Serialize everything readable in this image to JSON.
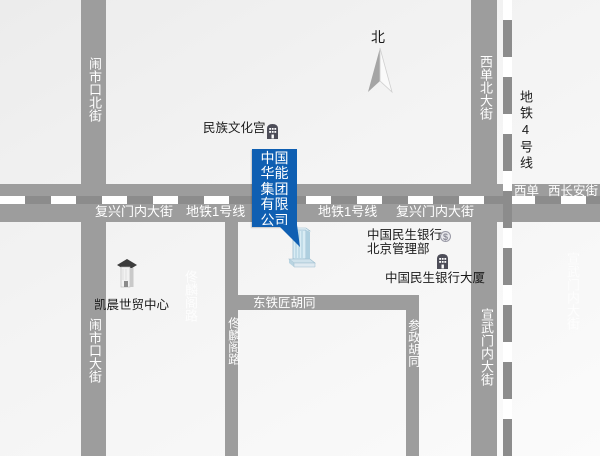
{
  "map": {
    "compass_label": "北",
    "callout": {
      "company_lines": [
        "中国",
        "华能",
        "集团",
        "有限",
        "公司"
      ],
      "full_name": "中国华能集团有限公司",
      "color": "#0f5fb2"
    },
    "roads": {
      "naoshikou_north": "闹市口北街",
      "naoshikou_south": "闹市口大街",
      "xidan_north": "西单北大街",
      "xuanwumen": "宣武门内大街",
      "tonglinge": "佟麟阁路",
      "canzheng": "参政胡同",
      "dongtiejiang": "东铁匠胡同",
      "fuxingmen": "复兴门内大街",
      "xichangan": "西长安街",
      "xidan_area": "西单"
    },
    "metro": {
      "line1": "地铁1号线",
      "line4": "地铁4号线"
    },
    "pois": {
      "minzu": "民族文化宫",
      "kaichen": "凯晨世贸中心",
      "minsheng_mgmt_line1": "中国民生银行",
      "minsheng_mgmt_line2": "北京管理部",
      "minsheng_tower": "中国民生银行大厦"
    },
    "icons": {
      "bank_symbol": "$"
    },
    "watermarks": {
      "left": "佟麟阁路",
      "right": "宣武门内大街"
    },
    "colors": {
      "road": "#9d9d9d",
      "metro_band": "#8c8c8c",
      "callout_blue": "#0f5fb2",
      "background": "#f3f3f3"
    }
  }
}
